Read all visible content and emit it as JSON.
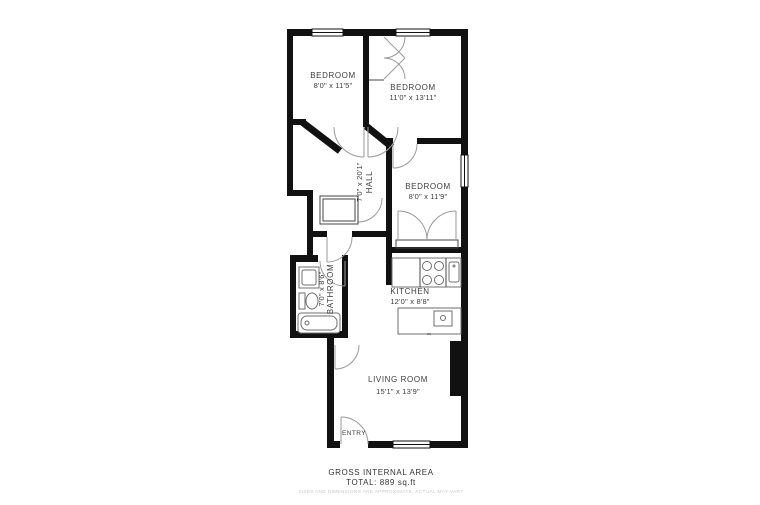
{
  "plan": {
    "rooms": [
      {
        "name": "BEDROOM",
        "dims": "8'0\" x 11'5\""
      },
      {
        "name": "BEDROOM",
        "dims": "11'0\" x 13'11\""
      },
      {
        "name": "BEDROOM",
        "dims": "8'0\" x 11'9\""
      },
      {
        "name": "HALL",
        "dims": "7'0\" x 20'1\""
      },
      {
        "name": "BATHROOM",
        "dims": "7'0\" x 8'6\""
      },
      {
        "name": "KITCHEN",
        "dims": "12'0\" x 8'8\""
      },
      {
        "name": "LIVING ROOM",
        "dims": "15'1\" x 13'9\""
      }
    ],
    "entry_label": "ENTRY",
    "footer": {
      "line1": "GROSS INTERNAL AREA",
      "line2": "TOTAL: 889 sq.ft",
      "disclaimer": "SIZES AND DIMENSIONS ARE APPROXIMATE, ACTUAL MAY VARY"
    },
    "colors": {
      "wall": "#111111",
      "label": "#3d3d3d",
      "door_arc": "#9a9a9a",
      "fixture": "#6f6f6f",
      "disclaimer": "#c8c8c8",
      "background": "#ffffff"
    }
  }
}
